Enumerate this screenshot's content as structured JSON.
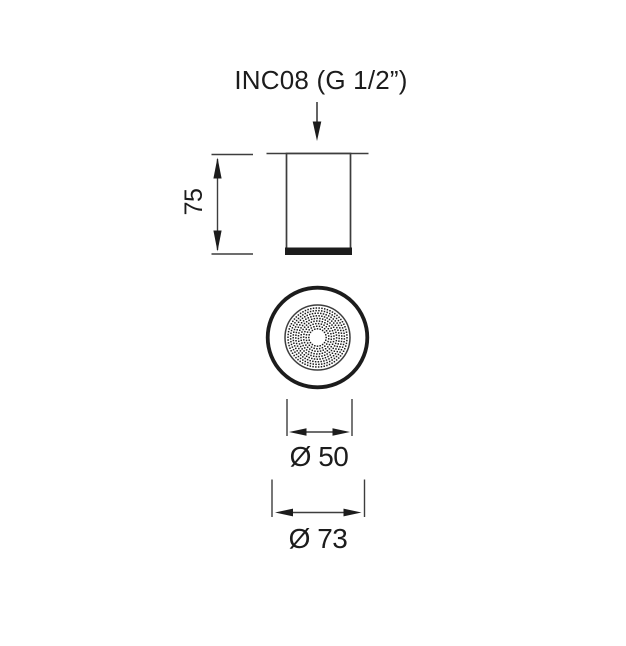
{
  "drawing": {
    "title": "INC08 (G 1/2”)",
    "dimensions": {
      "height": "75",
      "spray_diameter": "Ø 50",
      "overall_diameter": "Ø 73"
    },
    "colors": {
      "ink": "#1c1c1c",
      "line": "#3d3d3d",
      "background": "#ffffff"
    }
  }
}
